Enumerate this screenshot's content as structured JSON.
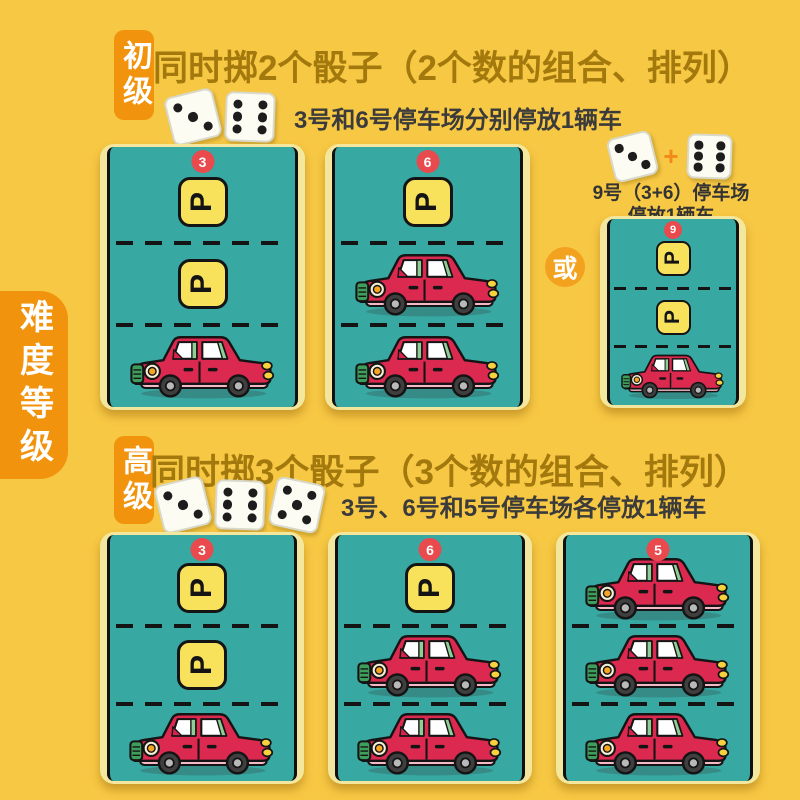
{
  "p_sign_label": "P",
  "side_label": "难度等级",
  "colors": {
    "background": "#F7C844",
    "accent_orange": "#F2930D",
    "or_circle_orange": "#F2A21F",
    "title_brown": "#A3790E",
    "instruction_gray": "#3B3B3B",
    "card_cream": "#F2E79C",
    "lot_teal": "#37A8A2",
    "sign_yellow": "#F8E25C",
    "badge_red": "#E84A4E",
    "car_red": "#DC2950"
  },
  "sections": [
    {
      "level_badge": "初级",
      "title": "同时掷2个骰子（2个数的组合、排列）",
      "dice": [
        3,
        6
      ],
      "instruction": "3号和6号停车场分别停放1辆车",
      "cards": [
        {
          "number": "3",
          "lanes": [
            "p",
            "p",
            "car"
          ]
        },
        {
          "number": "6",
          "lanes": [
            "p",
            "car",
            "car"
          ]
        }
      ],
      "or_label": "或",
      "alt": {
        "dice": [
          3,
          6
        ],
        "plus": "+",
        "caption_line1": "9号（3+6）停车场",
        "caption_line2": "停放1辆车",
        "card": {
          "number": "9",
          "lanes": [
            "p",
            "p",
            "car"
          ]
        }
      }
    },
    {
      "level_badge": "高级",
      "title": "同时掷3个骰子（3个数的组合、排列）",
      "dice": [
        3,
        6,
        5
      ],
      "instruction": "3号、6号和5号停车场各停放1辆车",
      "cards": [
        {
          "number": "3",
          "lanes": [
            "p",
            "p",
            "car"
          ]
        },
        {
          "number": "6",
          "lanes": [
            "p",
            "car",
            "car"
          ]
        },
        {
          "number": "5",
          "lanes": [
            "car",
            "car",
            "car"
          ]
        }
      ]
    }
  ]
}
